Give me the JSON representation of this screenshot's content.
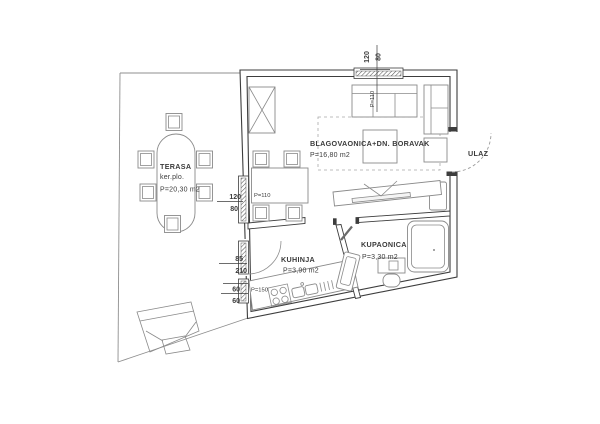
{
  "plan": {
    "rooms": {
      "living": {
        "name": "BLAGOVAONICA+DN. BORAVAK",
        "area": "P=16,80 m2"
      },
      "terrace": {
        "name": "TERASA",
        "finish": "ker.plo.",
        "area": "P=20,30 m2"
      },
      "kitchen": {
        "name": "KUHINJA",
        "area": "P=3,90 m2"
      },
      "bathroom": {
        "name": "KUPAONICA",
        "area": "P=3,30 m2"
      },
      "entrance": {
        "name": "ULAZ"
      }
    },
    "dims": {
      "top_window": {
        "w": "120",
        "h": "80",
        "parapet": "P=110"
      },
      "left_window": {
        "w": "120",
        "h": "80",
        "parapet": "P=110"
      },
      "terrace_door": {
        "w": "85",
        "h": "210"
      },
      "small_window": {
        "w": "60",
        "h": "60",
        "parapet": "P=150"
      }
    },
    "colors": {
      "wall_line": "#3d3d3d",
      "furniture_line": "#8a8a8a",
      "text": "#3b3b3b"
    }
  }
}
